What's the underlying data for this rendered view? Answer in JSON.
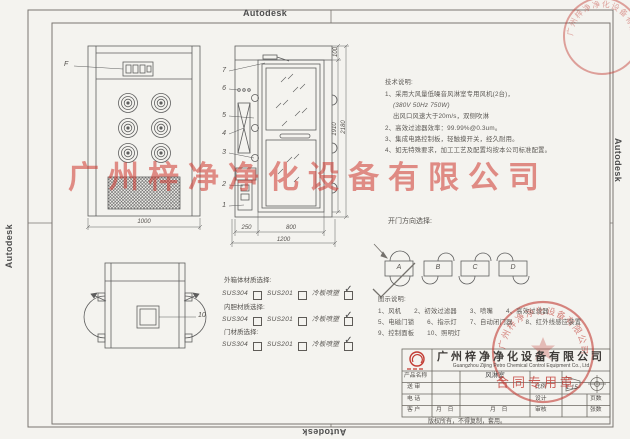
{
  "brand": "Autodesk",
  "watermark": "广州梓净净化设备有限公司",
  "seal": {
    "arc_text": "广州梓净净化设备有限公司",
    "label": "合同专用章"
  },
  "notes": {
    "title": "技术说明:",
    "lines": [
      "1、采用大风量低噪音风淋室专用风机(2台)，",
      "(380V 50Hz  750W)",
      "出风口风速大于20m/s，双侧吹淋",
      "2、高效过滤器效率：99.99%@0.3um。",
      "3、集成电路控制板，轻触摸开关，经久耐用。",
      "4、如无特殊要求，加工工艺及配置均按本公司标准配置。"
    ]
  },
  "door_options": {
    "title": "开门方向选择:",
    "options": [
      "A",
      "B",
      "C",
      "D"
    ]
  },
  "legend": {
    "title": "图示说明:",
    "rows": [
      "1、风机　　2、初效过滤器　　3、喷嘴　　4、高效过滤器",
      "5、电磁门锁　　6、指示灯　　7、自动闭门器　　8、红外线感应装置",
      "9、控制面板　　10、照明灯"
    ]
  },
  "materials": {
    "groups": [
      {
        "label": "外箱体材质选择:",
        "options": [
          {
            "name": "SUS304",
            "checked": false
          },
          {
            "name": "SUS201",
            "checked": false
          },
          {
            "name": "冷板喷塑",
            "checked": true
          }
        ]
      },
      {
        "label": "内胆材质选择:",
        "options": [
          {
            "name": "SUS304",
            "checked": false
          },
          {
            "name": "SUS201",
            "checked": false
          },
          {
            "name": "冷板喷塑",
            "checked": true
          }
        ]
      },
      {
        "label": "门材质选择:",
        "options": [
          {
            "name": "SUS304",
            "checked": false
          },
          {
            "name": "SUS201",
            "checked": false
          },
          {
            "name": "冷板喷塑",
            "checked": true
          }
        ]
      }
    ]
  },
  "dimensions": {
    "front_width": "1000",
    "section_left": "250",
    "section_door": "800",
    "section_total": "1200",
    "door_height": "1910",
    "total_height": "2180",
    "top_cap": "100"
  },
  "callouts": {
    "front_panel": "F",
    "section": [
      "7",
      "6",
      "5",
      "4",
      "3",
      "2",
      "1"
    ],
    "top_view_light": "10"
  },
  "title_block": {
    "company_cn": "广州梓净净化设备有限公司",
    "company_en": "Guangzhou Zijing Petro Chemical Control Equipment Co., Ltd",
    "product_label": "产品名称",
    "row_labels": [
      "送  审",
      "电  话",
      "客  户"
    ],
    "product_value": "风淋室",
    "scale_label": "比例",
    "scale_value": "1:15",
    "design_label": "设计",
    "audit_label": "审核",
    "pages_label": "页数",
    "sheets_label": "张数",
    "date_text": "月　日",
    "copyright": "版权所有，不得复制，套用。"
  },
  "colors": {
    "red": "#c23a32",
    "line": "#5e5e5e",
    "paper": "#f4f3ef"
  }
}
